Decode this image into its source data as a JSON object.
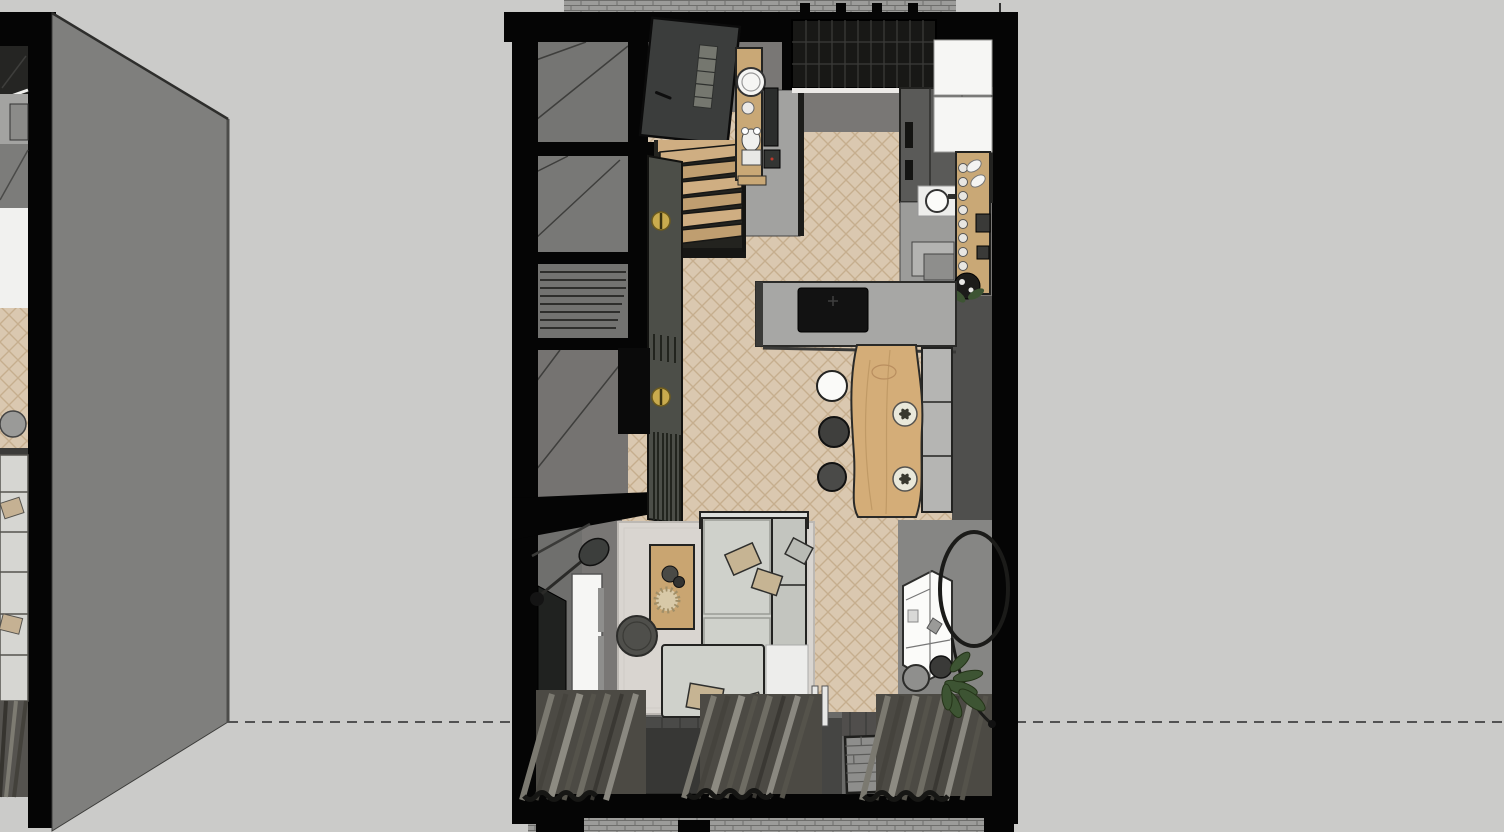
{
  "viewport": {
    "type": "3d-model-top-view",
    "scene": "Top-down 3D floor plan render of a studio apartment with herringbone wood floor",
    "plans": {
      "main": {
        "rooms": [
          "entry-hall",
          "wc",
          "kitchen",
          "dining-area",
          "living-room",
          "corridor",
          "storage-rooms"
        ],
        "furniture": [
          "entry-door",
          "staircase",
          "skylight",
          "vanity-sink",
          "toilet",
          "fridge-cabinets",
          "kitchen-sink",
          "coffee-bar",
          "kitchen-island-cooktop",
          "dining-table",
          "dining-chairs",
          "dining-bench",
          "pendant-lamps",
          "wardrobe",
          "sofa",
          "chaise",
          "coffee-table",
          "side-table",
          "tv",
          "tv-cabinet",
          "arc-floor-lamp",
          "shelf-unit",
          "hanging-chair",
          "plant",
          "stool",
          "rug",
          "doormat",
          "curtains"
        ]
      },
      "left_partial": {
        "visible": "right edge sliver of an identical neighbouring plan copy",
        "furniture": [
          "sofa",
          "curtains",
          "lamp",
          "counter"
        ]
      }
    },
    "annotations": {
      "section_line": {
        "style": "dashed",
        "y": 722
      },
      "tick_mark": {
        "x": 1000,
        "y": 3
      }
    }
  },
  "colors": {
    "canvas": "#cbcbc9",
    "section_line": "#2a2a2a",
    "black_wall": "#050505",
    "perspective_wall": "#7f7f7d",
    "perspective_wall_edge": "#4c4c4a",
    "interior_gray": "#797775",
    "room_gray": "#757573",
    "floor_wood": "#dac8b0",
    "plank_line": "#c6ae8e",
    "concrete": "#a2a2a0",
    "skylight": "#181816",
    "skylight_line": "#3c3c3a",
    "door_dark": "#3b3d3c",
    "cabinet_dark": "#5a5a58",
    "white": "#f6f6f4",
    "wood": "#c9a876",
    "table_wood": "#d4ad78",
    "island": "#a7a7a5",
    "cooktop": "#121212",
    "bench": "#b5b5b3",
    "chair_dark": "#3f3f3d",
    "pendant": "#e9e8da",
    "wardrobe": "#4c4e48",
    "brass": "#c9ab4e",
    "sofa": "#cfd1cb",
    "sofa_back": "#c3c5bf",
    "pillow": "#c6b493",
    "rug": "#d9d5d0",
    "coffee_table": "#c9a571",
    "side_table": "#4f4f4b",
    "tv": "#202220",
    "lamp": "#3c3e3c",
    "shelf_white": "#fbfbf9",
    "plant": "#3d5433",
    "pot_dark": "#3a3a38",
    "right_floor": "#868684",
    "shadow_zone": "#4f4f4d",
    "window_band": "#6a6a68",
    "mat_dark": "#373735",
    "doormat": "#8e8e8c",
    "curtain_dark": "#4c4a44",
    "brick": "#9c9c9a"
  }
}
